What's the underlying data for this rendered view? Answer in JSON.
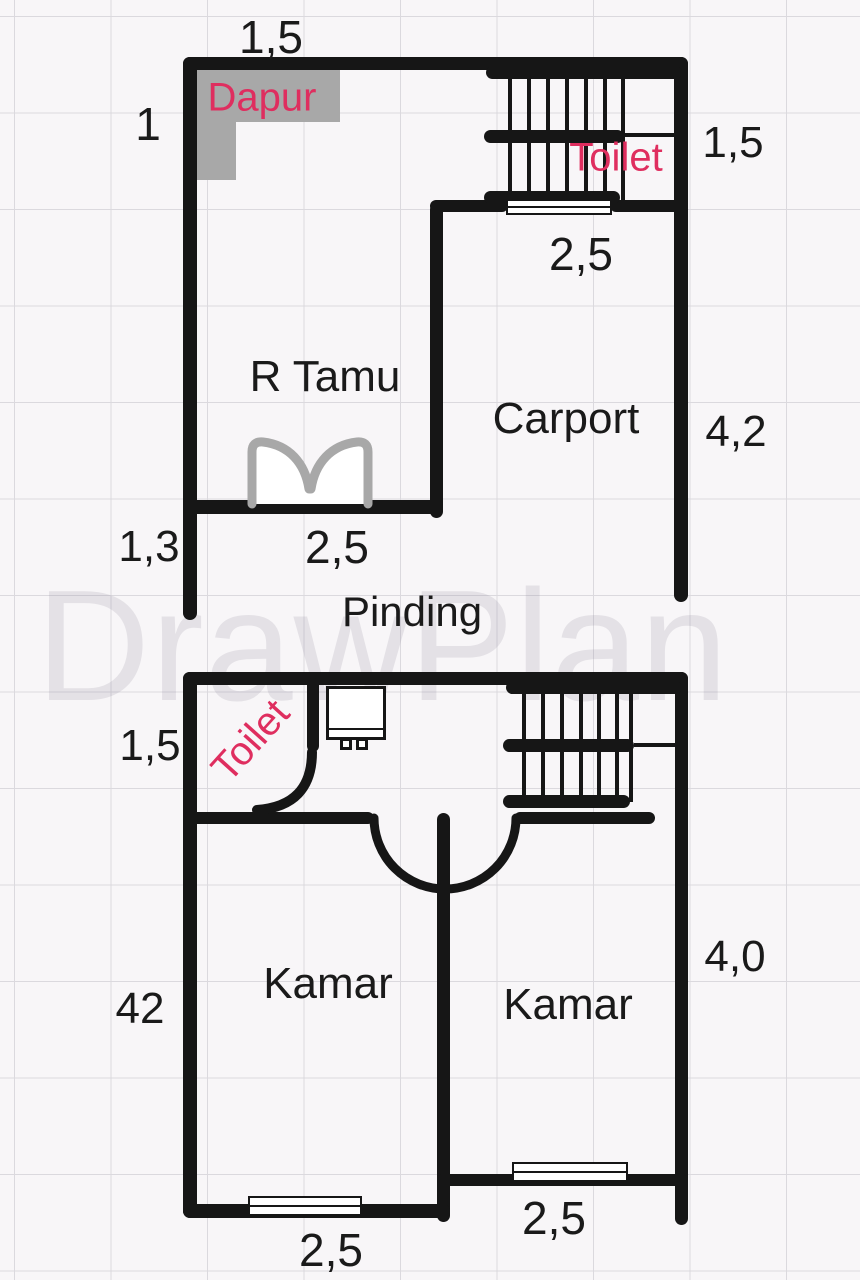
{
  "app": {
    "watermark": "DrawPlan"
  },
  "colors": {
    "wall": "#161616",
    "accent_pink": "#df2e5f",
    "counter_gray": "#a8a8a8",
    "grid_line": "#dbd9de",
    "background": "#f8f6f8"
  },
  "upper_floor": {
    "rooms": {
      "dapur": "Dapur",
      "toilet": "Toilet",
      "r_tamu": "R Tamu",
      "carport": "Carport",
      "pinding": "Pinding"
    },
    "dimensions": {
      "top_width": "1,5",
      "left_height": "1",
      "toilet_height": "1,5",
      "stairs_width": "2,5",
      "carport_height": "4,2",
      "left_lower_height": "1,3",
      "r_tamu_width": "2,5"
    },
    "icons": [
      "stairs-icon",
      "window-icon",
      "double-door-icon",
      "kitchen-counter-icon"
    ]
  },
  "lower_floor": {
    "rooms": {
      "toilet": "Toilet",
      "kamar_left": "Kamar",
      "kamar_right": "Kamar"
    },
    "dimensions": {
      "toilet_height": "1,5",
      "left_height": "42",
      "right_height": "4,0",
      "kamar_left_width": "2,5",
      "kamar_right_width": "2,5"
    },
    "icons": [
      "stairs-icon",
      "window-icon",
      "door-swing-icon",
      "washbasin-icon",
      "entry-door-arc-icon"
    ]
  }
}
